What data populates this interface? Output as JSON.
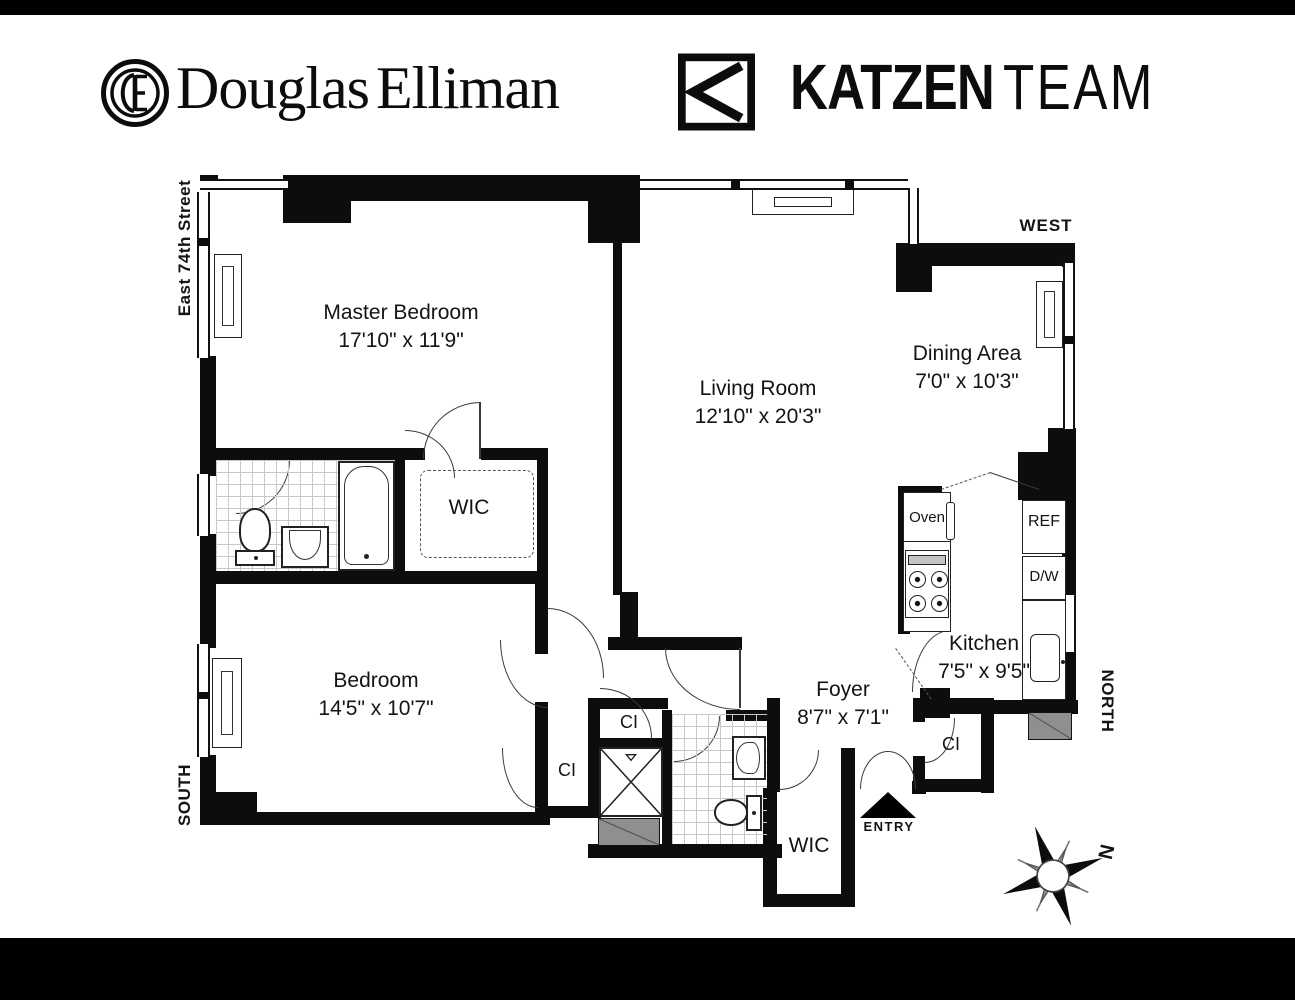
{
  "header": {
    "brand_first": "Douglas",
    "brand_second": "Elliman",
    "team_primary": "KATZEN",
    "team_secondary": "TEAM"
  },
  "plan": {
    "street_label": "East 74th Street",
    "compass": {
      "west": "WEST",
      "north": "NORTH",
      "south": "SOUTH",
      "rose_n": "N"
    },
    "entry_label": "ENTRY",
    "rooms": {
      "master_bedroom": {
        "name": "Master Bedroom",
        "dims": "17'10\" x 11'9\""
      },
      "living_room": {
        "name": "Living Room",
        "dims": "12'10\" x 20'3\""
      },
      "dining_area": {
        "name": "Dining Area",
        "dims": "7'0\" x 10'3\""
      },
      "bedroom": {
        "name": "Bedroom",
        "dims": "14'5\" x 10'7\""
      },
      "kitchen": {
        "name": "Kitchen",
        "dims": "7'5\" x 9'5\""
      },
      "foyer": {
        "name": "Foyer",
        "dims": "8'7\" x 7'1\""
      },
      "wic_upper": {
        "name": "WIC"
      },
      "wic_lower": {
        "name": "WIC"
      },
      "closet_hall": {
        "name": "CI"
      },
      "closet_bedroom": {
        "name": "CI"
      },
      "closet_entry": {
        "name": "CI"
      }
    },
    "appliances": {
      "oven": "Oven",
      "fridge": "REF",
      "dishwasher": "D/W"
    }
  },
  "colors": {
    "wall": "#0d0d0d",
    "shaded": "#8f8f8f",
    "bar": "#000000"
  }
}
